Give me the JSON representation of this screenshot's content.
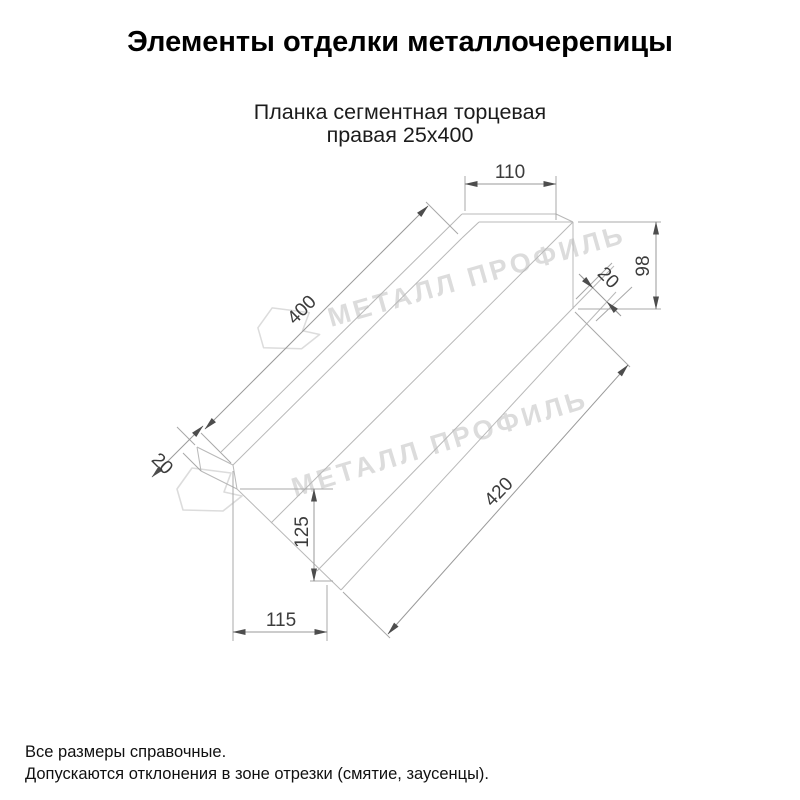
{
  "page": {
    "title": "Элементы отделки металлочерепицы"
  },
  "product": {
    "name_line1": "Планка сегментная торцевая",
    "name_line2": "правая 25х400"
  },
  "drawing": {
    "watermark_text": "МЕТАЛЛ ПРОФИЛЬ",
    "dims": {
      "top_flange_width": "110",
      "end_height": "98",
      "end_hem": "20",
      "top_length": "400",
      "left_hem": "20",
      "left_height": "125",
      "bottom_width": "115",
      "bottom_length": "420"
    }
  },
  "footer": {
    "note1": "Все размеры справочные.",
    "note2": "Допускаются отклонения в зоне отрезки (смятие, заусенцы)."
  },
  "colors": {
    "part_line": "#b8b8b8",
    "dim_line": "#9a9a9a",
    "dim_text": "#3c3c3c",
    "watermark": "#dcdcdc",
    "arrow": "#4d4d4d"
  }
}
